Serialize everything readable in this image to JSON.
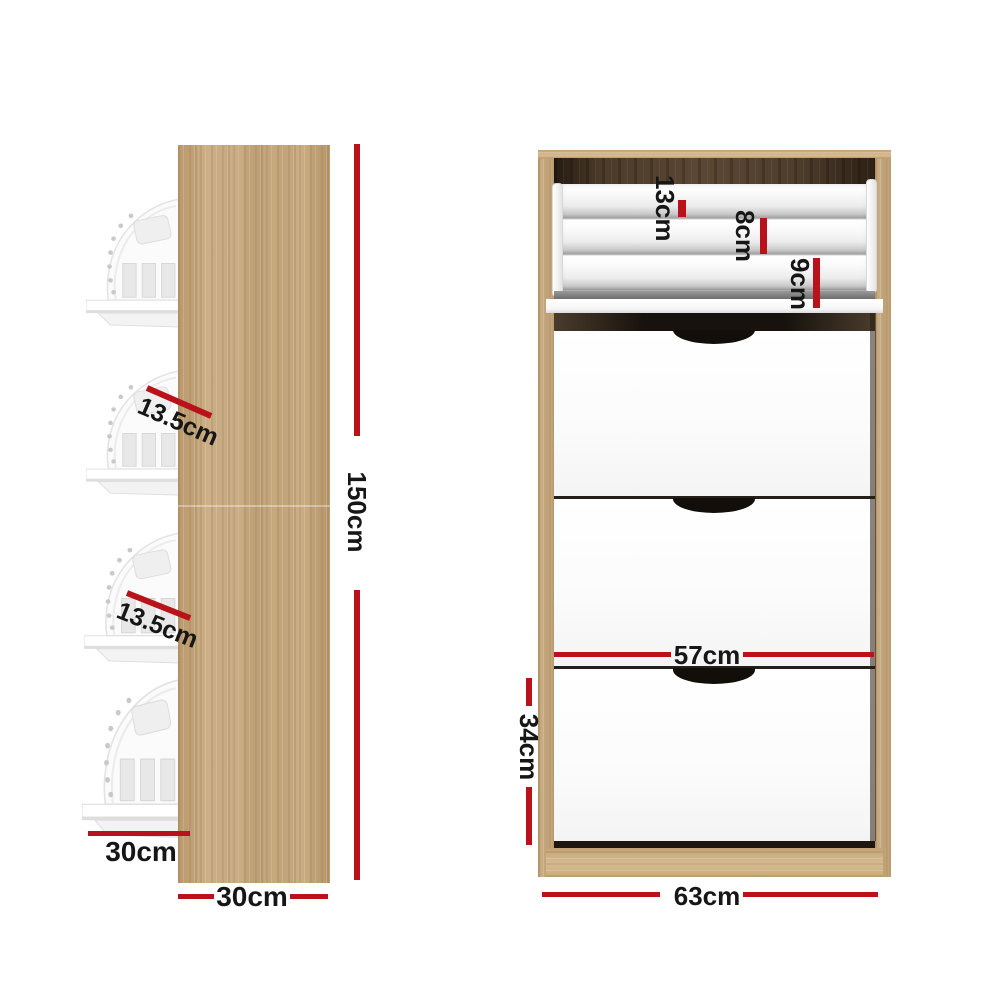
{
  "title": "Shoe cabinet dimension diagram",
  "colors": {
    "dimension_red": "#b9121a",
    "text_black": "#161616",
    "wood_light": "#cbac80",
    "wood_interior_dark": "#46362a",
    "panel_white": "#fdfdfd"
  },
  "side_view": {
    "height_label": "150cm",
    "panel_depth_label": "30cm",
    "shelf_depth_label": "30cm",
    "tilt_shelf_labels": [
      "13.5cm",
      "13.5cm"
    ]
  },
  "front_view": {
    "overall_width_label": "63cm",
    "inner_width_label": "57cm",
    "bottom_drawer_height_label": "34cm",
    "tray_tier_labels": [
      "13cm",
      "8cm",
      "9cm"
    ]
  }
}
